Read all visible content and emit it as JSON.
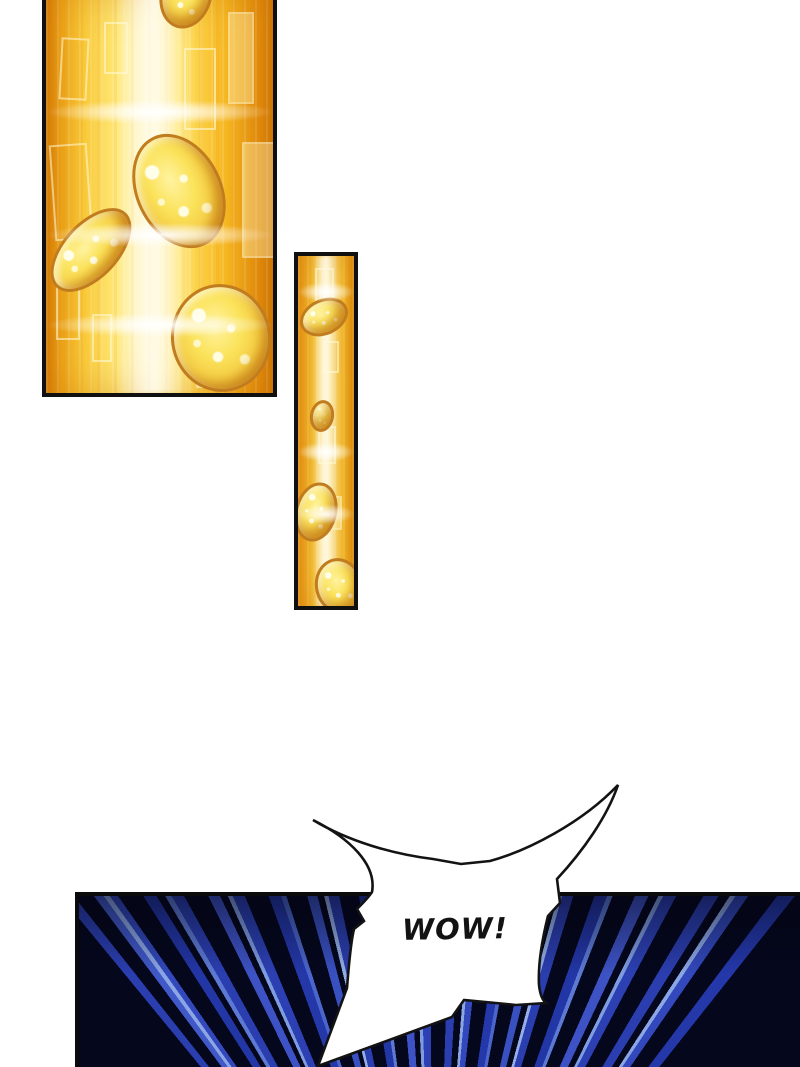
{
  "page": {
    "kind": "comic page",
    "background": "#ffffff"
  },
  "speech_bubble": {
    "text": "WOW!",
    "style": "spiky shout bubble",
    "fill": "#ffffff",
    "outline": "#131313"
  },
  "panels": [
    {
      "name": "gold coins large panel",
      "theme": "golden light beam with falling sparkling coins and faint floating rectangles",
      "coins_visible": 4,
      "palette": {
        "deep_orange": "#d97e06",
        "gold": "#f9ca3a",
        "beam_highlight": "#fff6cf",
        "coin_rim": "#c07c1e"
      }
    },
    {
      "name": "gold coins narrow panel",
      "theme": "golden light beam with falling sparkling coins",
      "coins_visible": 4,
      "palette": {
        "deep_orange": "#e89410",
        "gold": "#f8c838",
        "beam_highlight": "#fff1b2",
        "coin_rim": "#c07c1e"
      }
    },
    {
      "name": "blue speed lines panel",
      "theme": "radial blue action speed lines bursting upward",
      "palette": {
        "background": "#05071d",
        "ray_blue": "#2b3eb0",
        "ray_light_blue": "#8aa6e4"
      }
    }
  ]
}
